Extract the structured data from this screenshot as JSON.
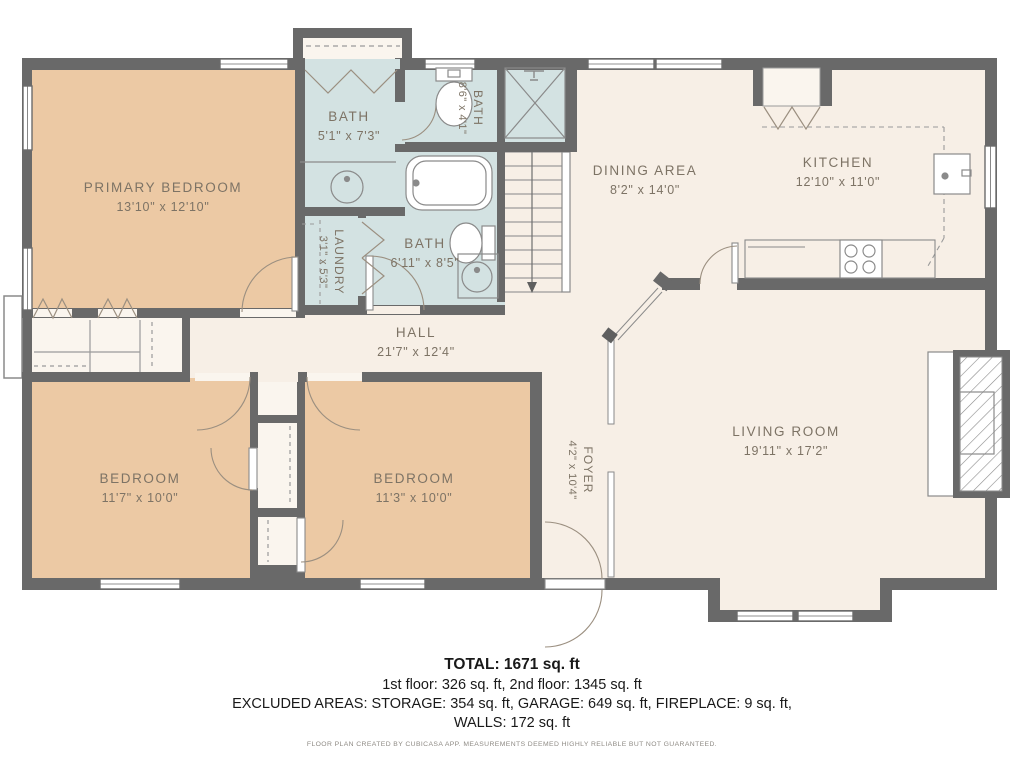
{
  "rooms": {
    "primary_bedroom": {
      "name": "PRIMARY BEDROOM",
      "dims": "13'10\" x 12'10\""
    },
    "bath_top": {
      "name": "BATH",
      "dims": "5'1\" x 7'3\""
    },
    "bath_small": {
      "name": "BATH",
      "dims": "8'6\" x 4'1\""
    },
    "laundry": {
      "name": "LAUNDRY",
      "dims": "3'1\" x 5'3\""
    },
    "bath_main": {
      "name": "BATH",
      "dims": "6'11\" x 8'5\""
    },
    "hall": {
      "name": "HALL",
      "dims": "21'7\" x 12'4\""
    },
    "dining": {
      "name": "DINING AREA",
      "dims": "8'2\" x 14'0\""
    },
    "kitchen": {
      "name": "KITCHEN",
      "dims": "12'10\" x 11'0\""
    },
    "bedroom_left": {
      "name": "BEDROOM",
      "dims": "11'7\" x 10'0\""
    },
    "bedroom_right": {
      "name": "BEDROOM",
      "dims": "11'3\" x 10'0\""
    },
    "foyer": {
      "name": "FOYER",
      "dims": "4'2\" x 10'4\""
    },
    "living_room": {
      "name": "LIVING ROOM",
      "dims": "19'11\" x 17'2\""
    }
  },
  "summary": {
    "total": "TOTAL: 1671 sq. ft",
    "floors": "1st floor: 326 sq. ft, 2nd floor: 1345 sq. ft",
    "excluded": "EXCLUDED AREAS: STORAGE: 354 sq. ft, GARAGE: 649 sq. ft, FIREPLACE: 9 sq. ft,",
    "walls": "WALLS: 172 sq. ft",
    "disclaimer": "FLOOR PLAN CREATED BY CUBICASA APP. MEASUREMENTS DEEMED HIGHLY RELIABLE BUT NOT GUARANTEED."
  },
  "colors": {
    "wall": "#696969",
    "bedroom_fill": "#ecc9a4",
    "wet_room_fill": "#d3e2e2",
    "floor_fill": "#f7efe6",
    "closet_fill": "#faf5ee",
    "label_text": "#7d7365"
  }
}
